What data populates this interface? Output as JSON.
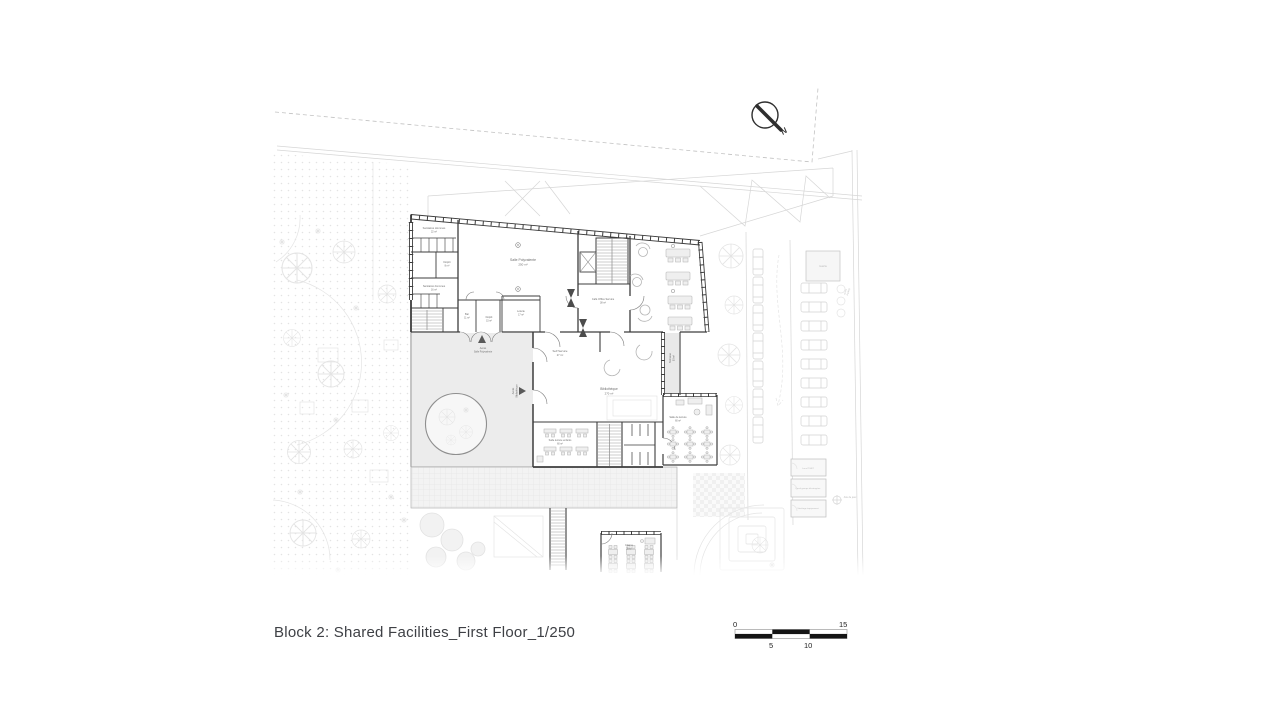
{
  "caption": {
    "text": "Block 2: Shared Facilities_First Floor_1/250"
  },
  "north": {
    "label": "N"
  },
  "scale_bar": {
    "zero": "0",
    "five": "5",
    "ten": "10",
    "fifteen": "15"
  },
  "colors": {
    "wall": "#3d3d3d",
    "courtyard_shade": "#ececec",
    "scale_black": "#141414",
    "caption_text": "#3e4045"
  },
  "rooms": [
    {
      "name": "Sanitaires Hommes",
      "area": "22 m²"
    },
    {
      "name": "Dépôt",
      "area": "8 m²"
    },
    {
      "name": "Sanitaires Femmes",
      "area": "16 m²"
    },
    {
      "name": "Salle Polyvalente",
      "area": "250 m²"
    },
    {
      "name": "Bar",
      "area": "11 m²"
    },
    {
      "name": "Dépôt",
      "area": "15 m²"
    },
    {
      "name": "Loterie",
      "area": "17 m²"
    },
    {
      "name": "Café Office Service",
      "area": "38 m²"
    },
    {
      "name": "Self Service",
      "area": "27 m²"
    },
    {
      "name": "Terrasse",
      "area": "50 m²"
    },
    {
      "name": "Bibliothèque",
      "area": "270 m²"
    },
    {
      "name": "Salle lecture enfants",
      "area": "60 m²"
    },
    {
      "name": "Salle de lecture",
      "area": "60 m²"
    },
    {
      "name": "Classe",
      "area": "35 m²"
    },
    {
      "name": "Guérite",
      "area": ""
    },
    {
      "name": "Local TGBT",
      "area": ""
    },
    {
      "name": "Local groupe électrogène",
      "area": ""
    },
    {
      "name": "Stockage équipement",
      "area": ""
    },
    {
      "name": "Aire de jeux",
      "area": ""
    }
  ],
  "access": [
    {
      "line1": "Accès",
      "line2": "Salle Polyvalente"
    },
    {
      "line1": "Accès",
      "line2": "Bibliothèque"
    },
    {
      "line1": "Accès",
      "line2": "Parking"
    }
  ]
}
